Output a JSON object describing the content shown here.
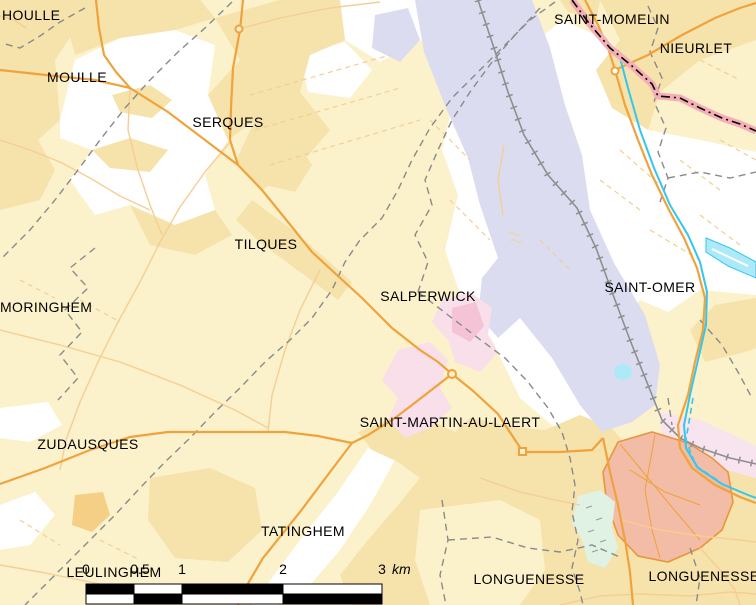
{
  "map": {
    "description": "Commune locator map of the Saint-Omer area (Pas-de-Calais / Nord, France)",
    "labels": {
      "houlle": "HOULLE",
      "moulle": "MOULLE",
      "serques": "SERQUES",
      "tilques": "TILQUES",
      "salperwick": "SALPERWICK",
      "moringhem": "MORINGHEM",
      "saint_omer": "SAINT-OMER",
      "saint_momelin": "SAINT-MOMELIN",
      "nieurlet": "NIEURLET",
      "zudausques": "ZUDAUSQUES",
      "saint_martin_au_laert": "SAINT-MARTIN-AU-LAERT",
      "tatinghem": "TATINGHEM",
      "leulinghem": "LEULINGHEM",
      "longuenesse_west": "LONGUENESSE",
      "longuenesse_east": "LONGUENESSE"
    },
    "scale_bar": {
      "tick_0": "0",
      "tick_05": "0.5",
      "tick_1": "1",
      "tick_2": "2",
      "tick_3": "3",
      "unit": "km"
    },
    "colors": {
      "background_farmland": "#FBF2CB",
      "open_land_white": "#FFFFFF",
      "village_tint": "#F6E2AB",
      "hamlet_tint": "#F4CF85",
      "wetland_lavender": "#DCDCF1",
      "urban_rose": "#F9DFE9",
      "urban_rose_dense": "#F5C3D6",
      "urban_salmon": "#F3BCA6",
      "urban_salmon_border": "#E8963C",
      "railway_corridor_pink": "#F8E4EE",
      "greenspace_mint": "#DFF2E4",
      "water_line": "#33C7EF",
      "water_fill": "#AEE9F8",
      "road_major": "#F0A23C",
      "road_minor": "#F6CE93",
      "railway_gray": "#8F8F8F",
      "commune_boundary_gray": "#8A8A8A",
      "department_boundary_band": "#F5AEB6",
      "department_boundary_dash": "#000000",
      "label_text": "#000000",
      "scale_bar_black": "#000000"
    }
  }
}
